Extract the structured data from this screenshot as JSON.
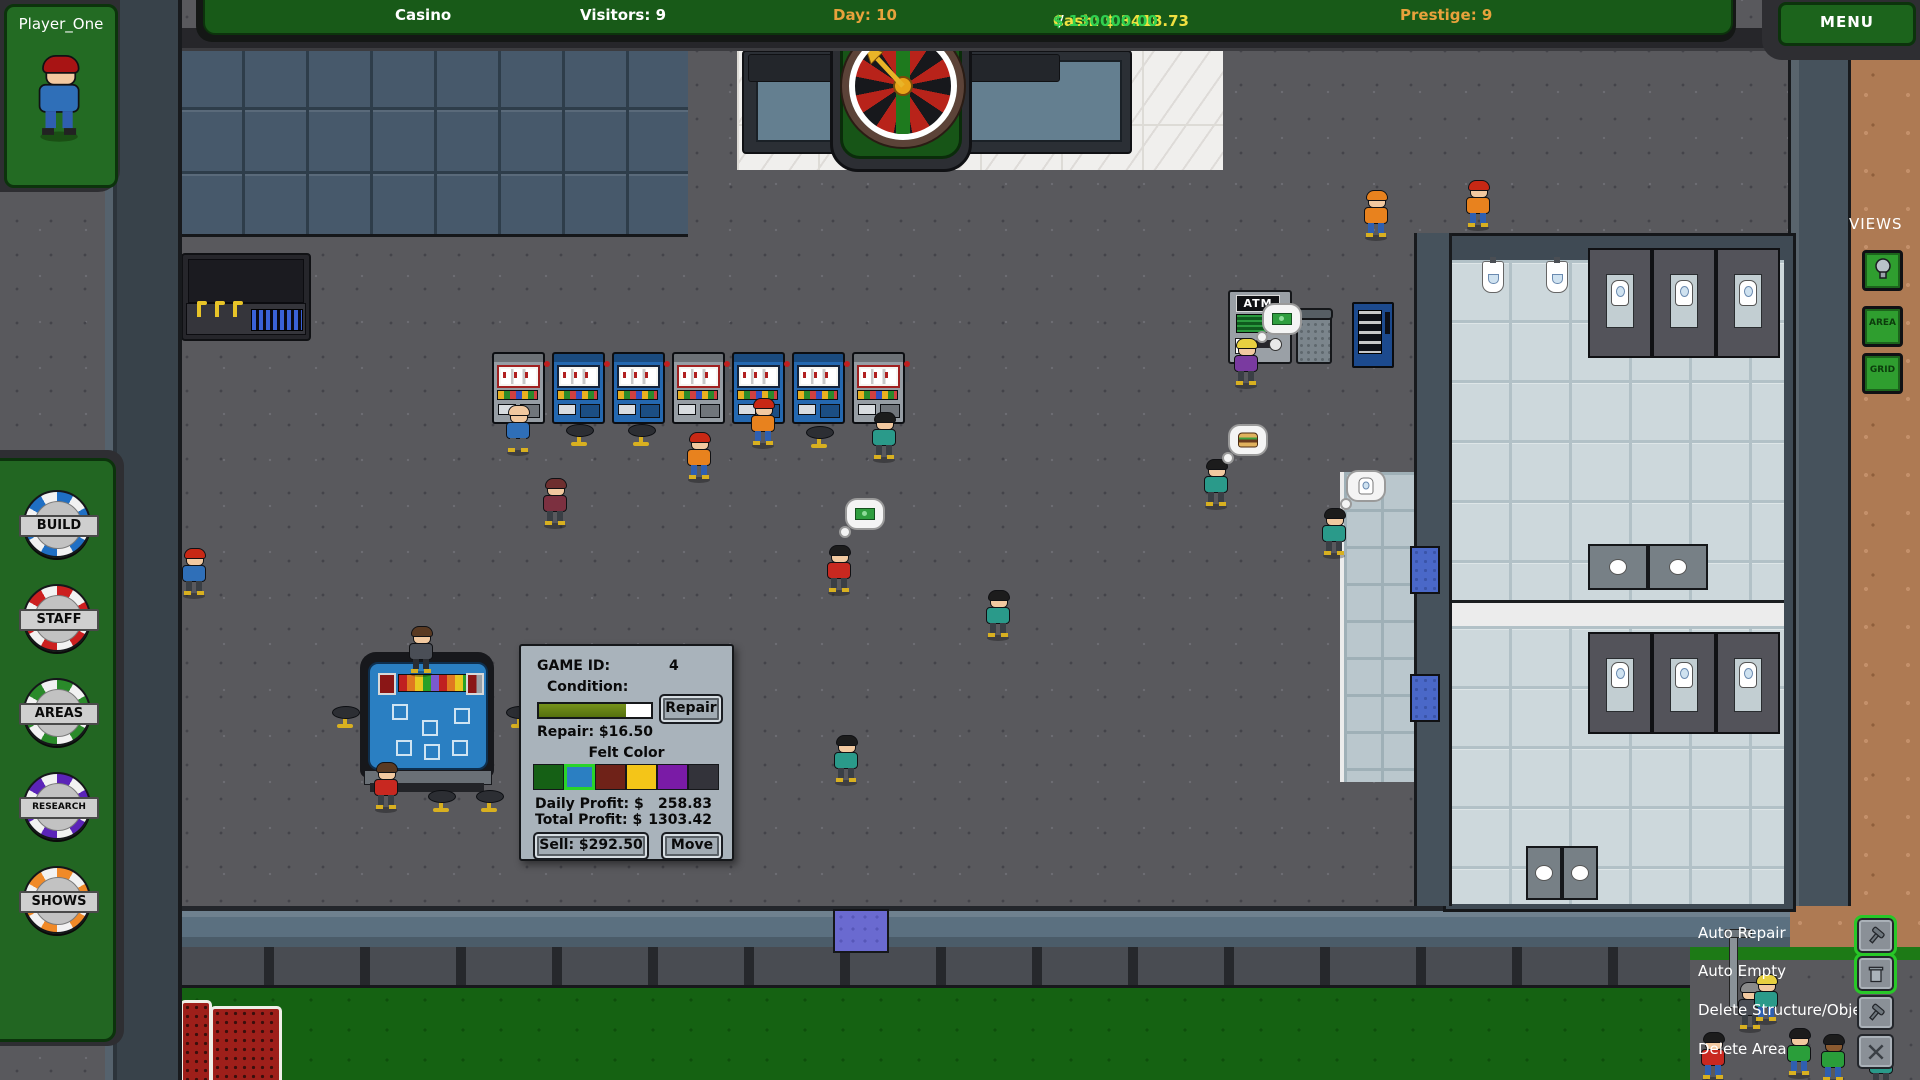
{
  "top_bar": {
    "casino": "Casino",
    "visitors": "Visitors: 9",
    "day": "Day: 10",
    "cash": "Cash: $ 3418.73",
    "cash_sep": " / ",
    "cash_goal": "$ 130000.00",
    "prestige": "Prestige: 9",
    "menu": "MENU",
    "day_color": "#e8a23c",
    "cash_color": "#f0e040",
    "goal_color": "#30d050"
  },
  "player_panel": {
    "name": "Player_One"
  },
  "sidebar": {
    "chips": [
      {
        "label": "BUILD",
        "color": "#1f6fc4",
        "font": 13
      },
      {
        "label": "STAFF",
        "color": "#cc1f1f",
        "font": 13
      },
      {
        "label": "AREAS",
        "color": "#2a8a2a",
        "font": 13
      },
      {
        "label": "RESEARCH",
        "color": "#5b24b8",
        "font": 9
      },
      {
        "label": "SHOWS",
        "color": "#f08a28",
        "font": 13
      }
    ]
  },
  "views_panel": {
    "title": "VIEWS",
    "area": "AREA",
    "grid": "GRID",
    "bulb_icon": "lightbulb-icon"
  },
  "options_panel": {
    "items": [
      {
        "label": "Auto Repair",
        "icon": "hammer",
        "active": true,
        "y": 918
      },
      {
        "label": "Auto Empty",
        "icon": "trash",
        "active": true,
        "y": 956
      },
      {
        "label": "Delete Structure/Object",
        "icon": "hammer",
        "active": false,
        "y": 995
      },
      {
        "label": "Delete Area",
        "icon": "x",
        "active": false,
        "y": 1034
      }
    ]
  },
  "game_panel": {
    "game_id_label": "GAME ID:",
    "game_id_value": "4",
    "condition_label": "Condition:",
    "condition_percent": 78,
    "repair_button": "Repair",
    "repair_cost": "Repair:  $16.50",
    "felt_color_label": "Felt Color",
    "felt_colors": [
      "#156015",
      "#2b7fc2",
      "#6f2218",
      "#f4c518",
      "#7a1ba6",
      "#33333a"
    ],
    "selected_felt_index": 1,
    "daily_profit_label": "Daily Profit:  $",
    "daily_profit_value": "258.83",
    "total_profit_label": "Total Profit:  $",
    "total_profit_value": "1303.42",
    "sell_button": "Sell: $292.50",
    "move_button": "Move"
  },
  "atm": {
    "sign": "ATM"
  },
  "world": {
    "slot_machines": [
      {
        "x": 492,
        "y": 352,
        "color": "gray"
      },
      {
        "x": 552,
        "y": 352,
        "color": "blue"
      },
      {
        "x": 612,
        "y": 352,
        "color": "blue"
      },
      {
        "x": 672,
        "y": 352,
        "color": "gray"
      },
      {
        "x": 732,
        "y": 352,
        "color": "blue"
      },
      {
        "x": 792,
        "y": 352,
        "color": "blue"
      },
      {
        "x": 852,
        "y": 352,
        "color": "gray"
      }
    ],
    "stools": [
      {
        "x": 566,
        "y": 424
      },
      {
        "x": 628,
        "y": 424
      },
      {
        "x": 806,
        "y": 426
      },
      {
        "x": 332,
        "y": 706
      },
      {
        "x": 506,
        "y": 706
      },
      {
        "x": 428,
        "y": 790
      },
      {
        "x": 476,
        "y": 790
      }
    ],
    "people": [
      {
        "x": 505,
        "y": 405,
        "hair": "#f2c9a0",
        "shirt": "#2f6fb8",
        "pants": "#555a60"
      },
      {
        "x": 686,
        "y": 432,
        "hair": "#c82814",
        "shirt": "#e8821e",
        "pants": "#2f5fb0"
      },
      {
        "x": 750,
        "y": 398,
        "hair": "#c82814",
        "shirt": "#e8821e",
        "pants": "#2f5fb0"
      },
      {
        "x": 871,
        "y": 412,
        "hair": "#1c1c1c",
        "shirt": "#2a9a8a",
        "pants": "#3a3f45"
      },
      {
        "x": 542,
        "y": 478,
        "hair": "#6e2f2f",
        "shirt": "#7c3040",
        "pants": "#3a3f45"
      },
      {
        "x": 181,
        "y": 548,
        "hair": "#c82814",
        "shirt": "#2f6fb8",
        "pants": "#3a3f45"
      },
      {
        "x": 826,
        "y": 545,
        "hair": "#1c1c1c",
        "shirt": "#c82820",
        "pants": "#3a3f45"
      },
      {
        "x": 408,
        "y": 626,
        "hair": "#5a3a22",
        "shirt": "#4a4e56",
        "pants": "#2a2d33"
      },
      {
        "x": 373,
        "y": 762,
        "hair": "#5a3a22",
        "shirt": "#c82820",
        "pants": "#3a3f45"
      },
      {
        "x": 833,
        "y": 735,
        "hair": "#1c1c1c",
        "shirt": "#2a9a8a",
        "pants": "#3a3f45"
      },
      {
        "x": 1203,
        "y": 459,
        "hair": "#1c1c1c",
        "shirt": "#2a9a8a",
        "pants": "#3a3f45"
      },
      {
        "x": 1321,
        "y": 508,
        "hair": "#1c1c1c",
        "shirt": "#2a9a8a",
        "pants": "#3a3f45"
      },
      {
        "x": 1233,
        "y": 338,
        "hair": "#e8d040",
        "shirt": "#7a3aa0",
        "pants": "#3a3f45"
      },
      {
        "x": 985,
        "y": 590,
        "hair": "#1c1c1c",
        "shirt": "#2a9a8a",
        "pants": "#3a3f45"
      },
      {
        "x": 1363,
        "y": 190,
        "hair": "#e8821e",
        "shirt": "#e8821e",
        "pants": "#2f5fb0"
      },
      {
        "x": 1465,
        "y": 180,
        "hair": "#c82814",
        "shirt": "#e8821e",
        "pants": "#2f5fb0"
      },
      {
        "x": 1700,
        "y": 1032,
        "hair": "#1c1c1c",
        "shirt": "#c82820",
        "pants": "#2f5fb0"
      },
      {
        "x": 1737,
        "y": 982,
        "hair": "#8a8a8a",
        "shirt": "#4a4e56",
        "pants": "#3a3f45"
      },
      {
        "x": 1753,
        "y": 974,
        "hair": "#e8d040",
        "shirt": "#2a9a8a",
        "pants": "#2f5fb0"
      },
      {
        "x": 1786,
        "y": 1028,
        "hair": "#1c1c1c",
        "shirt": "#2a9e3a",
        "pants": "#2f5fb0"
      },
      {
        "x": 1820,
        "y": 1034,
        "hair": "#1c1c1c",
        "shirt": "#2a9e3a",
        "pants": "#2f5fb0",
        "skin": "#8a5a30"
      },
      {
        "x": 1868,
        "y": 1040,
        "hair": "#1c1c1c",
        "shirt": "#2a9a8a",
        "pants": "#3a3f45"
      }
    ],
    "bubbles": [
      {
        "x": 845,
        "y": 498,
        "icon": "money"
      },
      {
        "x": 1262,
        "y": 303,
        "icon": "money"
      },
      {
        "x": 1228,
        "y": 424,
        "icon": "burger"
      },
      {
        "x": 1346,
        "y": 470,
        "icon": "toilet"
      }
    ]
  }
}
